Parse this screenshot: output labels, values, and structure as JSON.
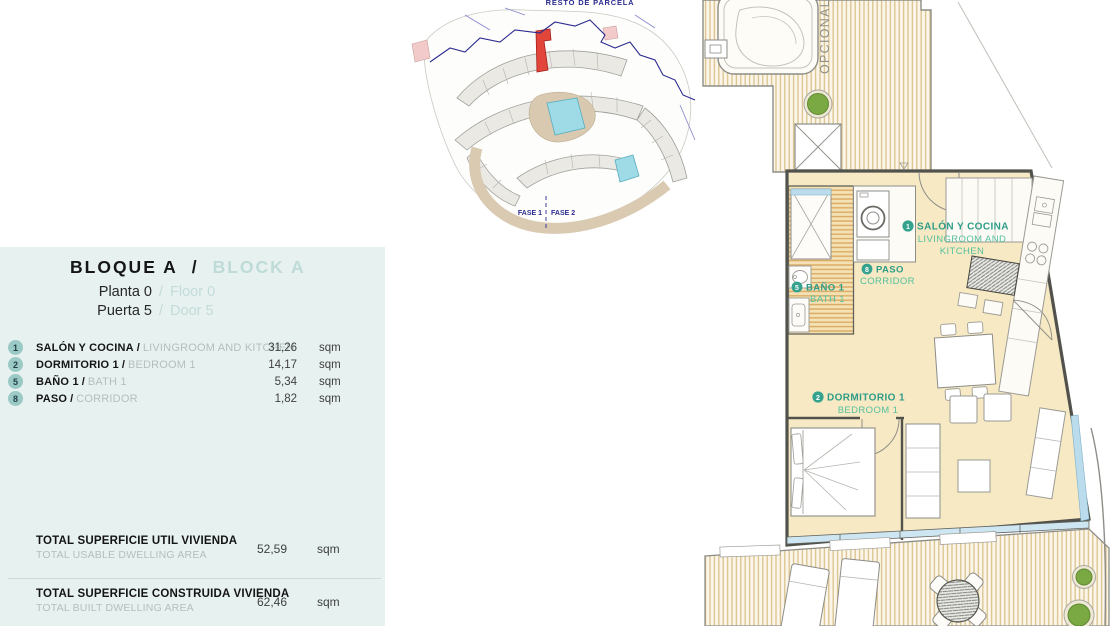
{
  "panel": {
    "sep": "/",
    "title_es": "BLOQUE A",
    "title_en": "BLOCK A",
    "floor_es": "Planta 0",
    "floor_en": "Floor 0",
    "door_es": "Puerta 5",
    "door_en": "Door 5",
    "unit": "sqm",
    "rooms": [
      {
        "num": "1",
        "name_es": "SALÓN Y COCINA",
        "name_en": "LIVINGROOM AND KITCHEN",
        "area": "31,26"
      },
      {
        "num": "2",
        "name_es": "DORMITORIO 1",
        "name_en": "BEDROOM 1",
        "area": "14,17"
      },
      {
        "num": "5",
        "name_es": "BAÑO 1",
        "name_en": "BATH 1",
        "area": "5,34"
      },
      {
        "num": "8",
        "name_es": "PASO",
        "name_en": "CORRIDOR",
        "area": "1,82"
      }
    ],
    "totals": [
      {
        "label_es": "TOTAL SUPERFICIE UTIL VIVIENDA",
        "label_en": "TOTAL USABLE DWELLING AREA",
        "value": "52,59"
      },
      {
        "label_es": "TOTAL SUPERFICIE CONSTRUIDA VIVIENDA",
        "label_en": "TOTAL BUILT DWELLING AREA",
        "value": "62,46"
      }
    ]
  },
  "site_plan": {
    "top_label": "RESTO DE PARCELA",
    "phase_1": "FASE 1",
    "phase_2": "FASE 2"
  },
  "floor_plan": {
    "optional": "OPCIONAL",
    "salon": {
      "num": "1",
      "es": "SALÓN Y COCINA",
      "en_line1": "LIVINGROOM AND",
      "en_line2": "KITCHEN"
    },
    "paso": {
      "num": "8",
      "es": "PASO",
      "en": "CORRIDOR"
    },
    "bano": {
      "num": "5",
      "es": "BAÑO 1",
      "en": "BATH 1"
    },
    "dormitorio": {
      "num": "2",
      "es": "DORMITORIO 1",
      "en": "BEDROOM 1"
    }
  },
  "colors": {
    "accent_teal": "#35a28e",
    "pale_teal": "#bedbd7",
    "panel_bg": "#e7f1f0",
    "highlight_red": "#e2463b",
    "floor_cream": "#f6e9c4",
    "boundary_blue": "#2b2b8f",
    "glass_blue": "#badcec"
  }
}
